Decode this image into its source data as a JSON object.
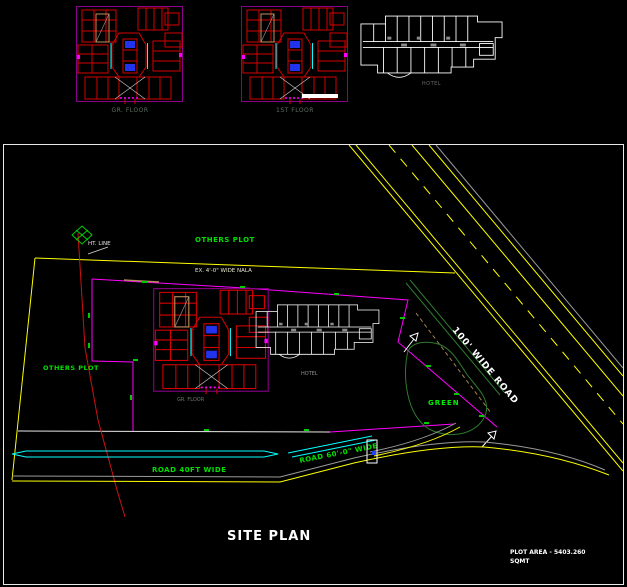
{
  "top_strip": {
    "plans": [
      {
        "label": "GR. FLOOR"
      },
      {
        "label": "1ST FLOOR"
      },
      {
        "label": "HOTEL"
      }
    ]
  },
  "site_plan": {
    "title": "SITE PLAN",
    "labels": {
      "others_plot_top": "OTHERS PLOT",
      "others_plot_left": "OTHERS PLOT",
      "ht_line": "HT. LINE",
      "nala": "EX. 4'-0\" WIDE NALA",
      "road_diagonal": "100' WIDE ROAD",
      "green_area": "GREEN",
      "road_bottom": "ROAD 40FT WIDE",
      "road_entrance": "ROAD 60'-0\" WIDE",
      "building_tower": "GR. FLOOR",
      "building_hotel": "HOTEL",
      "plot_area_line1": "PLOT AREA -  5403.260",
      "plot_area_line2": "SQMT"
    }
  },
  "colors": {
    "boundary_magenta": "#ff00ff",
    "road_yellow": "#ffff00",
    "ht_line_red": "#cc1111",
    "water_cyan": "#00ffff",
    "tick_green": "#00cc00",
    "text_green": "#00e000",
    "median_dark_green": "#2f7a2f",
    "plan_red": "#d40000",
    "plan_purple": "#8a008a",
    "core_blue": "#2233ee",
    "stair_tan": "#c09060",
    "white": "#ffffff",
    "gray": "#9a9a9a"
  }
}
